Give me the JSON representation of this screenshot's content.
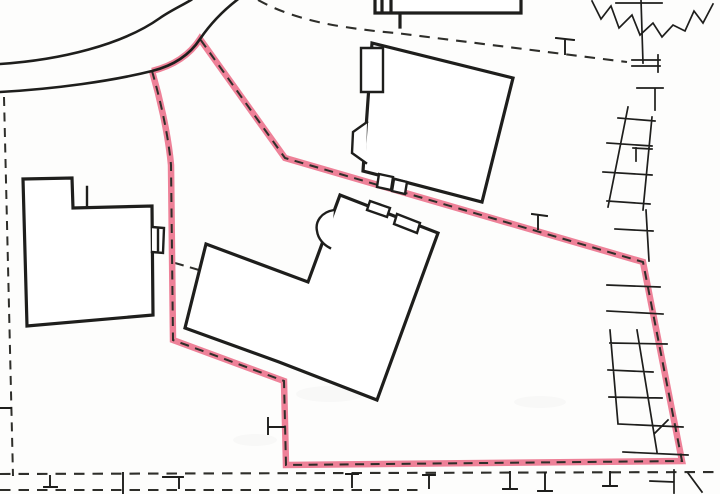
{
  "meta": {
    "title": "Site location plan with highlighted plot boundary",
    "type": "scanned-map"
  },
  "colors": {
    "paper": "#fdfdfc",
    "ink": "#1e1e1c",
    "dash_ink": "#2e2e2a",
    "boundary_pink": "#ee8198",
    "smudge_gray": "#9a9a96"
  },
  "map": {
    "paths": {
      "road_outer_edge": "M0,64 C60,60 122,45 160,18 C170,11 181,6 191,0",
      "road_inner_edge": "M0,92 C55,89 112,81 152,71 C172,66 189,56 200,39 C211,23 224,10 237,0",
      "plot_boundary": "M152,71 C159,95 168,132 171,165 L173,340 L284,381 L286,465 L682,461 L643,262 L285,158 L200,39 C189,56 172,66 152,71",
      "plot_boundary_dashes": "M152,71 C159,95 168,132 171,165 L173,340 L284,381 L286,465 L682,461 L643,262 L285,158 L200,39",
      "parcel_dash_left_vertical": "M4,97 L13,476",
      "parcel_dash_top_curve": "M258,0 C278,11 305,21 345,27 C365,30 382,32 396,33 L627,62",
      "parcel_dash_bottom_upper": "M0,474 L720,472",
      "parcel_dash_bottom_lower": "M0,490 L420,490",
      "parcel_dash_tie": "M175,263 L199,270",
      "left_building_outline": "M23,179 L72,178 L73,208 L152,206 L153,315 L27,326 Z",
      "left_building_details": "M87,187 L87,205 M152,227 L164,228 L163,253 L152,252 M158,230 L158,250",
      "upper_building_outline": "M372,43 L513,78 L482,202 L363,171 Z",
      "upper_building_details": "M361,48 L383,48 L383,92 L361,92 Z M367,122 L353,132 L352,153 L366,163 M379,174 L393,177 L391,190 L377,187 Z M394,179 L407,182 L405,194 L392,191 Z",
      "top_building_outline": "M375,0 L375,13 L521,13 L521,0 M382,0 L382,13 M391,0 L391,12 M400,14 L400,27",
      "lower_building_outline": "M340,195 L438,233 L377,400 L279,362 L185,328 L206,244 L308,282 Z",
      "lower_building_details": "M334,210 C321,212 315,222 317,231 C318,239 324,245 330,248 M370,201 L390,208 L387,217 L367,210 Z M397,214 L420,223 L417,233 L394,224 Z",
      "fence_right_top": "M641,0 L643,63 M616,3 L662,3 M632,60 L660,60 M632,66 L660,66 M658,55 L658,72 M637,88 L663,88 M655,88 L655,110",
      "ladder_upper": "M628,107 L608,207 M652,117 L643,210 M618,118 L655,121 M607,143 L652,146 M603,172 L652,175 M607,201 L650,204 M633,148 L652,149 M636,148 L636,161",
      "fence_right_mid": "M646,210 L649,261 M615,229 L653,231 M607,285 L660,287 M607,311 L663,314",
      "ladder_lower": "M610,330 L618,424 M637,330 L657,452 M610,343 L667,344 M608,370 L653,372 M609,397 L662,398 M618,424 L683,427 M623,452 L688,455 M655,433 L668,420",
      "fence_bottom_right": "M674,470 L674,493 M650,481 L674,482 M688,473 L702,492",
      "boundary_post_top": "M556,38 L574,40 M565,40 L565,54",
      "boundary_post_mid": "M532,214 L547,216 M538,216 L538,229",
      "boundary_post_left": "M268,418 L268,434 M268,427 L284,427",
      "boundary_posts_bottom": "M50,476 L50,487 M44,487 L57,487 M123,473 L123,494 M163,477 L183,477 M179,477 L179,488 M346,474 L358,474 M352,474 L352,487 M423,475 L435,475 M429,475 L429,488 M510,472 L510,488 M503,489 L517,489 M545,473 L545,490 M538,491 L552,491 M610,472 L610,485 M603,486 L617,486 M0,408 L11,408",
      "tree_symbol": "M592,1 L601,19 L611,6 L619,28 L632,15 L640,35 L653,23 L662,37 L673,25 L685,31 L694,11 L703,23 L713,4"
    }
  }
}
